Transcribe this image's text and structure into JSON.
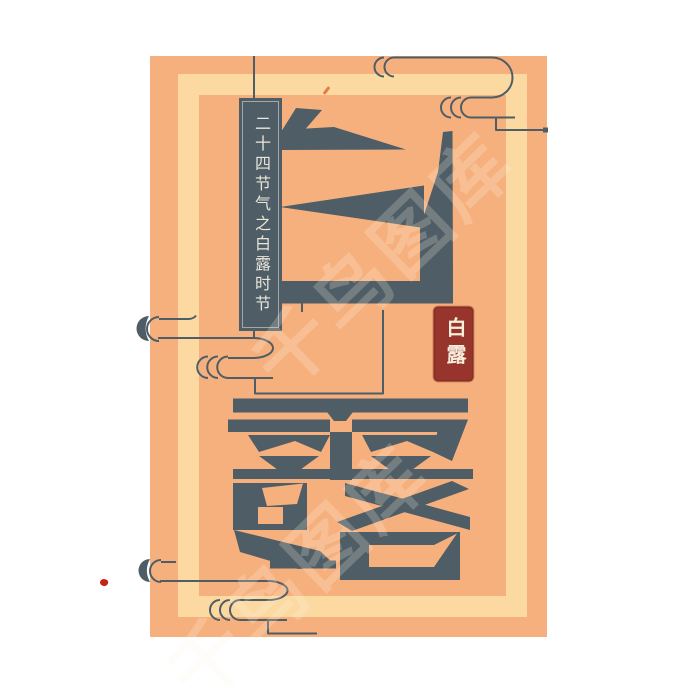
{
  "poster": {
    "series_label": "二十四节气之白露时节",
    "main_title": "白露",
    "main_title_chars": [
      "白",
      "露"
    ],
    "seal_text": "白露",
    "watermark_text": "千鸟图库",
    "colors": {
      "page_bg": "#FFFFFF",
      "card_bg": "#F5B07D",
      "frame": "#FBD9A1",
      "ink": "#4E5D66",
      "banner_bg": "#4E5D66",
      "banner_text": "#EAE6DA",
      "seal_bg": "#97352C",
      "seal_text_color": "#F6EDDB",
      "accent_red": "#C7231A",
      "accent_orange": "#DE6A33"
    }
  }
}
